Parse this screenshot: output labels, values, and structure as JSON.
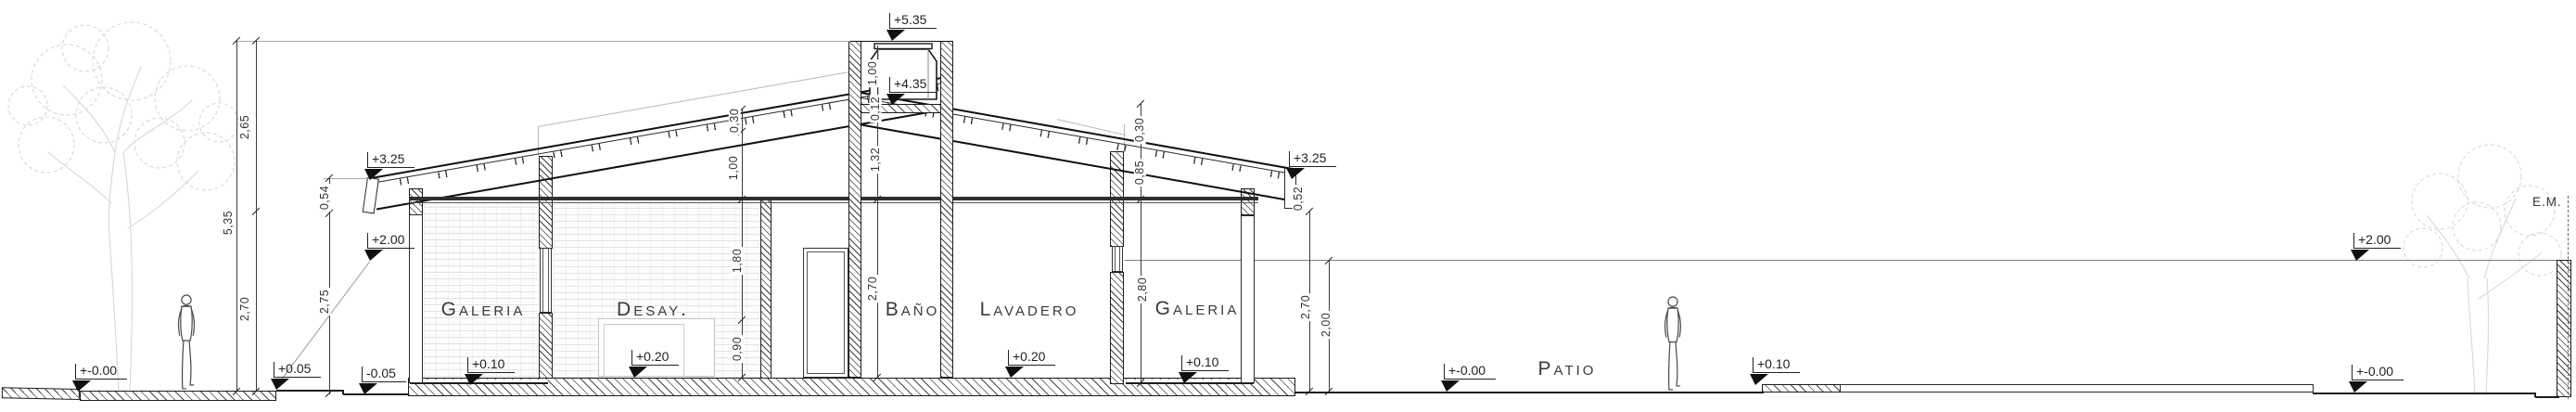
{
  "rooms": {
    "galeria_left": "Galeria",
    "desay": "Desay.",
    "bano": "Baño",
    "lavadero": "Lavadero",
    "galeria_right": "Galeria",
    "patio": "Patio"
  },
  "boundary": {
    "em": "E.M."
  },
  "levels": {
    "sidewalk": "+-0.00",
    "entry_step": "+0.05",
    "garden": "-0.05",
    "eave_left": "+3.25",
    "wall_left": "+2.00",
    "galeria_left_floor": "+0.10",
    "desay_floor": "+0.20",
    "tower_top": "+5.35",
    "tank_base": "+4.35",
    "lavadero_floor": "+0.20",
    "galeria_right_floor": "+0.10",
    "eave_right": "+3.25",
    "patio_ground": "+-0.00",
    "walkway": "+0.10",
    "fence_right": "+2.00",
    "ground_right": "+-0.00"
  },
  "dims": {
    "left_upper": "2,65",
    "left_total": "5,35",
    "left_lower": "2,70",
    "eave_fascia": "0,54",
    "eave_clear": "2,75",
    "roof_thickness_left": "0,30",
    "roof_to_ceiling_left": "1,00",
    "desay_upper": "1,80",
    "desay_sill": "0,90",
    "tank_height": "1,00",
    "tank_slab": "0,12",
    "shaft": "1,32",
    "bano_height": "2,70",
    "roof_thickness_right": "0,30",
    "roof_edge_right": "0,85",
    "galeria_right_height": "2,80",
    "fascia_right": "0,52",
    "eave_right_clear": "2,70",
    "fence_height": "2,00"
  },
  "colors": {
    "line": "#1a1a1a",
    "faint": "#cfcfcf",
    "accent": "#101010"
  }
}
